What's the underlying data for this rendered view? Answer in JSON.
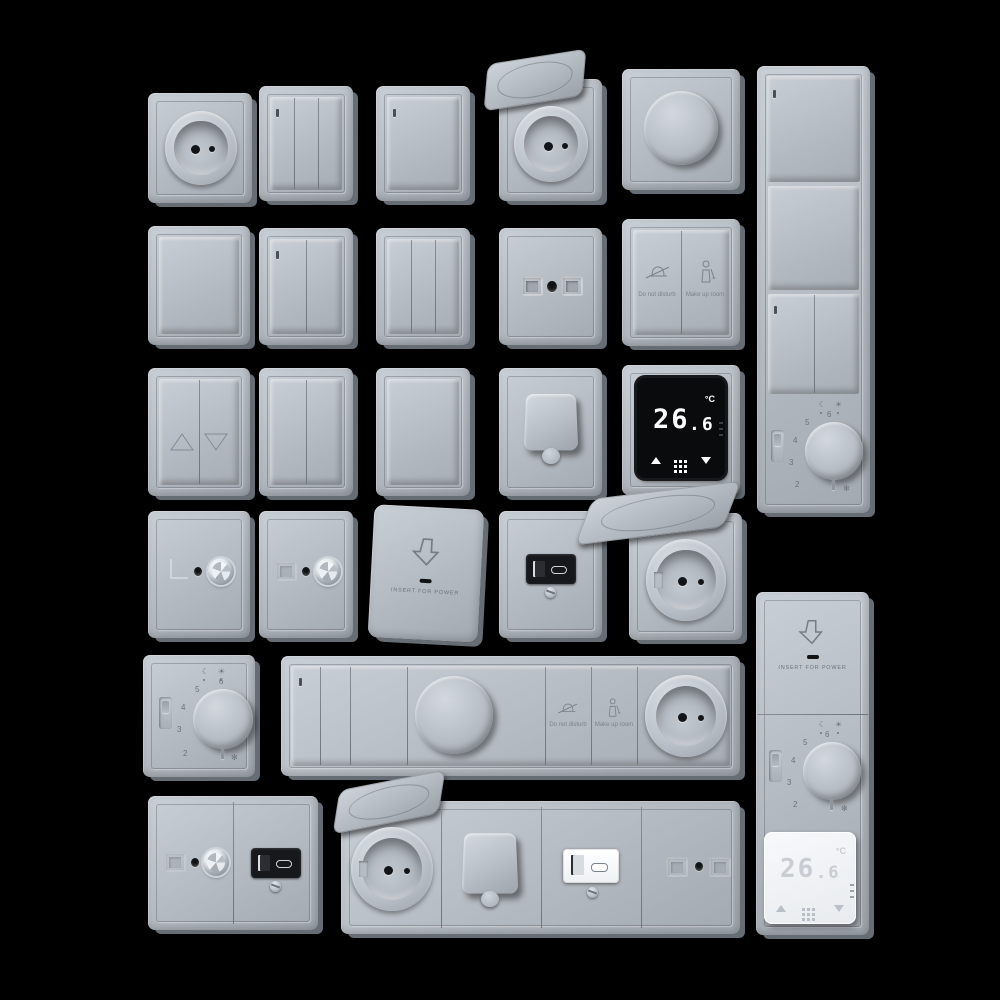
{
  "scene": {
    "background_color": "#000000",
    "plate_color": "#b7bdc4",
    "plate_shadow_color": "#666d75",
    "screen_black_color": "#0a0b0d",
    "screen_white_color": "#f4f6f8",
    "digit_white_color": "#ffffff",
    "digit_gray_color": "#c7cdd3"
  },
  "devices": {
    "dnd_plate": {
      "left_button": {
        "icon": "bell-slash-icon",
        "label": "Do not disturb"
      },
      "right_button": {
        "icon": "maid-icon",
        "label": "Make up room"
      }
    },
    "keycard_plate": {
      "icon": "arrow-down-icon",
      "label": "INSERT FOR POWER"
    },
    "thermostat_black": {
      "temp_whole": "26",
      "temp_decimal": ".6",
      "unit": "°C",
      "icons": [
        "triangle-up-icon",
        "dots-grid-icon",
        "triangle-down-icon"
      ]
    },
    "thermostat_white": {
      "temp_whole": "26",
      "temp_decimal": ".6",
      "unit": "°C",
      "icons": [
        "triangle-up-icon",
        "dots-grid-icon",
        "triangle-down-icon"
      ]
    },
    "dial": {
      "scale": [
        "2",
        "3",
        "4",
        "5",
        "6"
      ],
      "frost_symbol": "✻",
      "icons": [
        "moon-icon",
        "sun-icon"
      ]
    },
    "row5_panel": {
      "dnd_label": "Do not disturb",
      "makeup_label": "Make up room"
    },
    "right_panel_bottom": {
      "keycard_label": "INSERT FOR POWER",
      "scale": [
        "2",
        "3",
        "4",
        "5",
        "6"
      ],
      "thermostat": {
        "temp_whole": "26",
        "temp_decimal": ".6",
        "unit": "°C"
      }
    },
    "right_panel_top": {
      "scale": [
        "2",
        "3",
        "4",
        "5",
        "6"
      ]
    }
  }
}
